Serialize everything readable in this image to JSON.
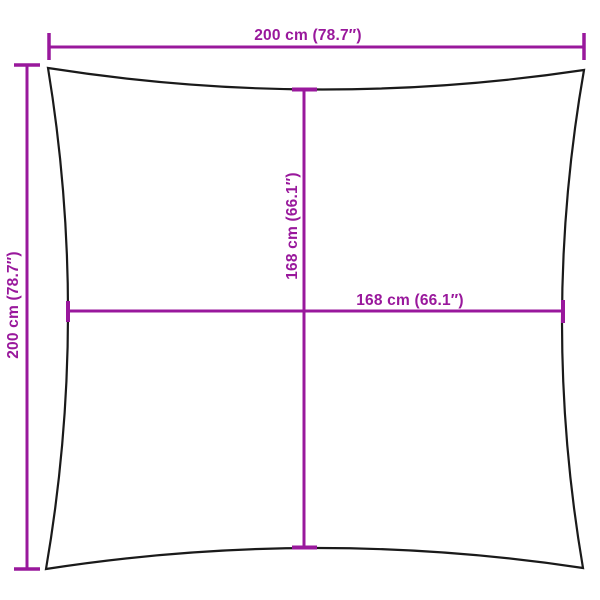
{
  "diagram": {
    "type": "product-dimension-diagram",
    "subject": "square shade sail with concave edges",
    "labels": {
      "top_width": "200 cm (78.7″)",
      "left_height": "200 cm (78.7″)",
      "inner_vertical": "168 cm (66.1″)",
      "inner_horizontal": "168 cm (66.1″)"
    },
    "measurements": {
      "outer_width_cm": 200,
      "outer_width_in": 78.7,
      "outer_height_cm": 200,
      "outer_height_in": 78.7,
      "inner_span_vertical_cm": 168,
      "inner_span_vertical_in": 66.1,
      "inner_span_horizontal_cm": 168,
      "inner_span_horizontal_in": 66.1
    },
    "colors": {
      "dimension": "#99189C",
      "outline": "#1a1a1a",
      "background": "#ffffff"
    }
  }
}
